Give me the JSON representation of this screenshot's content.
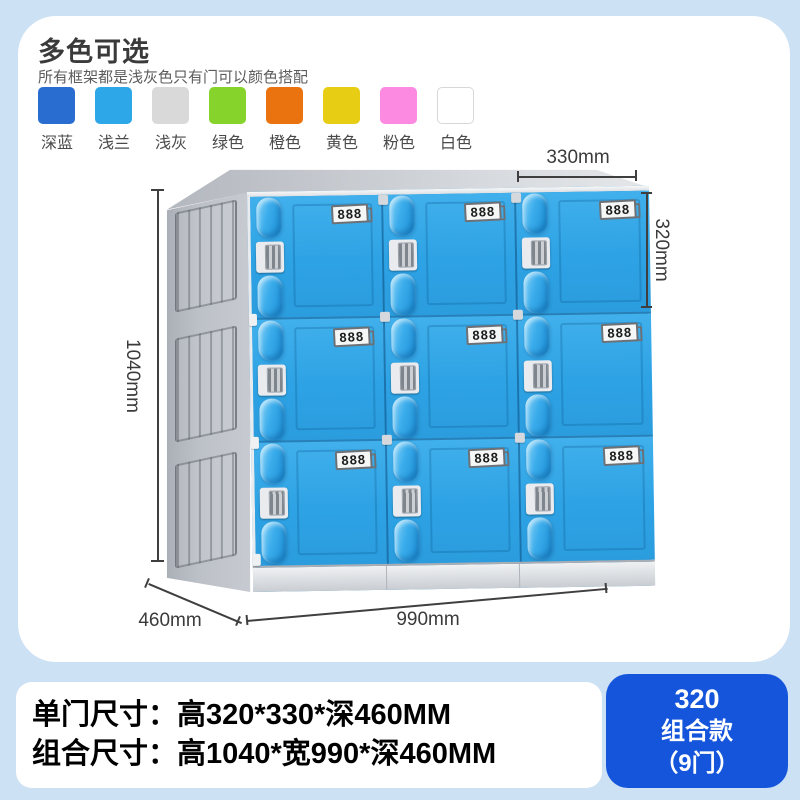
{
  "page": {
    "background": "#cde1f4"
  },
  "header": {
    "title": "多色可选",
    "subtitle": "所有框架都是浅灰色只有门可以颜色搭配"
  },
  "color_options": [
    {
      "label": "深蓝",
      "color": "#2a6dd0"
    },
    {
      "label": "浅兰",
      "color": "#2ea7e9"
    },
    {
      "label": "浅灰",
      "color": "#d9d9d9"
    },
    {
      "label": "绿色",
      "color": "#85d32b"
    },
    {
      "label": "橙色",
      "color": "#ea7310"
    },
    {
      "label": "黄色",
      "color": "#e8cd15"
    },
    {
      "label": "粉色",
      "color": "#fc8ae1"
    },
    {
      "label": "白色",
      "color": "#ffffff",
      "border": "#d8d8d8"
    }
  ],
  "locker": {
    "rows": 3,
    "cols": 3,
    "door_plate_label": "888",
    "door_color": "#2fa3e3",
    "frame_color": "#bcc0c7"
  },
  "dimensions": {
    "door_width": "330mm",
    "door_height": "320mm",
    "total_height": "1040mm",
    "depth": "460mm",
    "total_width": "990mm"
  },
  "specs": {
    "line1": "单门尺寸：高320*330*深460MM",
    "line2": "组合尺寸：高1040*宽990*深460MM"
  },
  "badge": {
    "line1": "320",
    "line2": "组合款",
    "line3": "（9门）",
    "bg": "#1455db"
  }
}
